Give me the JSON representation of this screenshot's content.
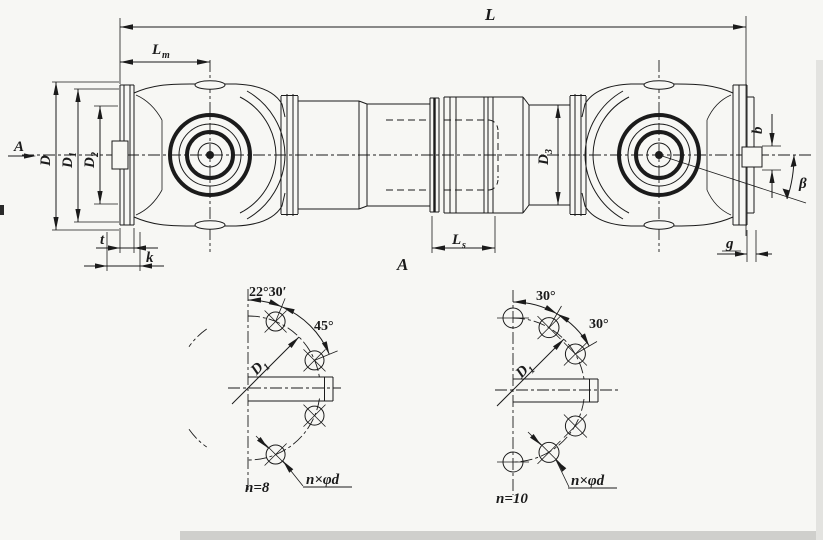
{
  "page": {
    "paper": "#f7f7f4",
    "ink": "#1b1b1b"
  },
  "main_view": {
    "overall_length": "L",
    "joint_length": {
      "base": "L",
      "sub": "m"
    },
    "spline_length": {
      "base": "L",
      "sub": "s"
    },
    "flange_diameter": "D",
    "bolt_circle_diameter": {
      "base": "D",
      "sub": "1"
    },
    "spigot_diameter": {
      "base": "D",
      "sub": "2"
    },
    "tube_diameter": {
      "base": "D",
      "sub": "3"
    },
    "flange_plate_thickness": "t",
    "flange_overall_thickness": "k",
    "boss_width": "b",
    "face_gap": "g",
    "articulation_angle": "β",
    "section_arrow": "A",
    "section_view_label": "A"
  },
  "flange_view_n8": {
    "offset_angle": "22°30′",
    "pitch_angle": "45°",
    "bolt_circle": {
      "base": "D",
      "sub": "1"
    },
    "hole_count": "n=8",
    "hole_callout": "n×φd"
  },
  "flange_view_n10": {
    "offset_angle": "30°",
    "pitch_angle": "30°",
    "bolt_circle": {
      "base": "D",
      "sub": "1"
    },
    "hole_count": "n=10",
    "hole_callout": "n×φd"
  }
}
